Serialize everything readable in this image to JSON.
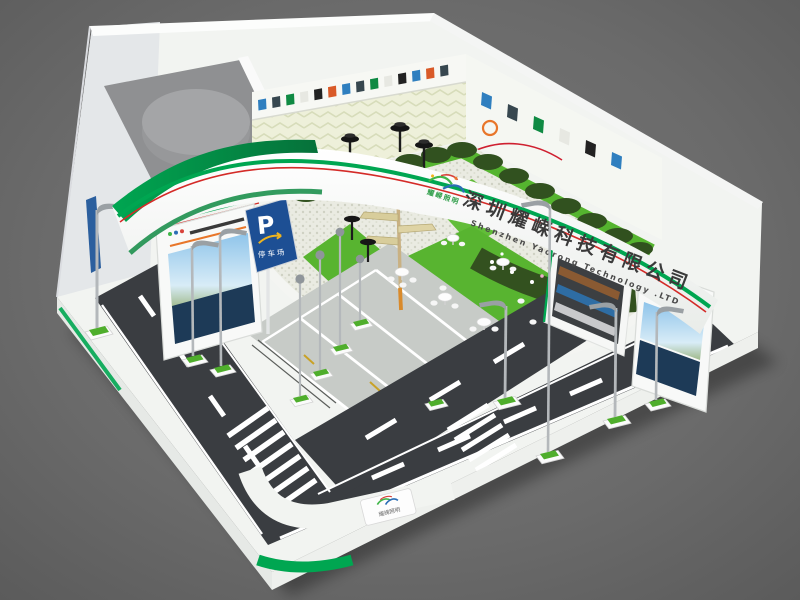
{
  "scene": {
    "title": "Exhibition booth 3D render",
    "background_color": "#696969"
  },
  "branding": {
    "logo_text": "耀嵘照明",
    "company_name_cn": "深圳耀嵘科技有限公司",
    "company_name_en": "Shenzhen Yaorong Technology .LTD",
    "accent_green": "#00a651",
    "accent_dark_green": "#0b7a3e",
    "accent_red": "#d42b28"
  },
  "parking_sign": {
    "symbol": "P",
    "label": "停车场",
    "panel_color": "#1d4f94",
    "arrow_color": "#efb41e"
  },
  "floor_badge": {
    "label": "耀嵘照明"
  },
  "palette": {
    "road": "#3a3d41",
    "grass": "#58b430",
    "hedge": "#31511f",
    "wall_white": "#f2f4f1",
    "parking_lot": "#c7cbc7",
    "gravel": "#e9eae1"
  }
}
